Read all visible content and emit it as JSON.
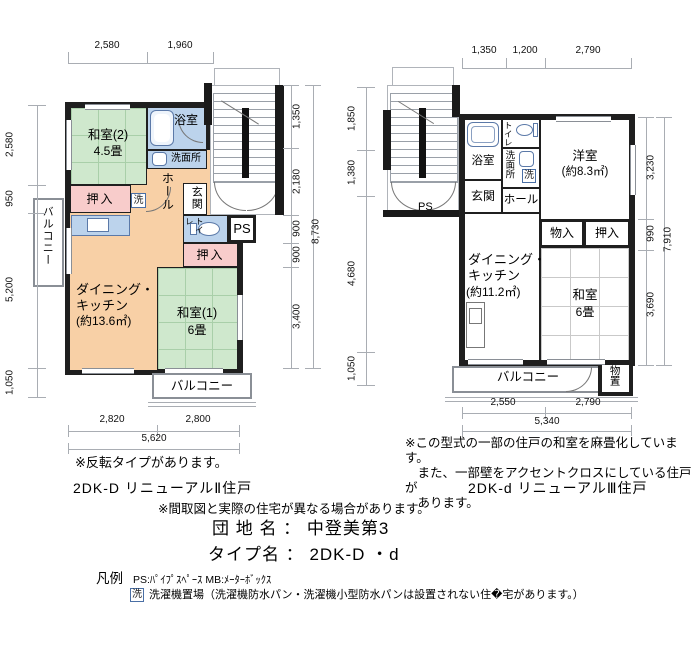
{
  "left": {
    "dims_top": [
      "2,580",
      "1,960"
    ],
    "dims_left": [
      "2,580",
      "950",
      "5,200",
      "1,050"
    ],
    "dims_right": [
      "1,350",
      "2,180",
      "900",
      "900",
      "3,400"
    ],
    "dims_right_total": "8,730",
    "dims_bottom": [
      "2,820",
      "2,800"
    ],
    "dims_bottom_total": "5,620",
    "rooms": {
      "washitsu2": "和室(2)",
      "washitsu2_size": "4.5畳",
      "bath": "浴室",
      "senmenjo": "洗面所",
      "hall": "ホール",
      "genkan": "玄関",
      "toilet": "トイレ",
      "ps": "PS",
      "oshiire1": "押入",
      "oshiire2": "押入",
      "laundry": "洗",
      "dk": "ダイニング・\nキッチン",
      "dk_size": "(約13.6㎡)",
      "washitsu1": "和室(1)",
      "washitsu1_size": "6畳",
      "balcony_left": "バルコニー",
      "balcony_bottom": "バルコニー"
    },
    "note": "※反転タイプがあります。",
    "label": "2DK-D リニューアルⅡ住戸"
  },
  "right": {
    "dims_top": [
      "1,350",
      "1,200",
      "2,790"
    ],
    "dims_left": [
      "1,850",
      "1,380",
      "4,680",
      "1,050"
    ],
    "dims_right": [
      "3,230",
      "990",
      "3,690"
    ],
    "dims_right_total": "7,910",
    "dims_bottom": [
      "2,550",
      "2,790"
    ],
    "dims_bottom_total": "5,340",
    "rooms": {
      "bath": "浴室",
      "toilet": "トイレ",
      "senmenjo": "洗面所",
      "laundry": "洗",
      "genkan": "玄関",
      "hall": "ホール",
      "yoshitsu": "洋室",
      "yoshitsu_size": "(約8.3㎡)",
      "monoiri": "物入",
      "oshiire": "押入",
      "dk": "ダイニング・\nキッチン",
      "dk_size": "(約11.2㎡)",
      "washitsu": "和室",
      "washitsu_size": "6畳",
      "balcony": "バルコニー",
      "storage": "物置",
      "ps": "PS"
    },
    "note": "※この型式の一部の住戸の和室を麻畳化しています。\n　また、一部壁をアクセントクロスにしている住戸が\n　あります。",
    "label": "2DK-d リニューアルⅢ住戸"
  },
  "footer": {
    "disclaimer": "※間取図と実際の住宅が異なる場合があります。",
    "danchi": "団 地 名 ： 中登美第3",
    "type": "タイプ名 ： 2DK-D ・d",
    "legend_title": "凡例",
    "legend_ps": "PS:ﾊﾟｲﾌﾟｽﾍﾟｰｽ MB:ﾒｰﾀｰﾎﾞｯｸｽ",
    "legend_laundry_mark": "洗",
    "legend_laundry": "洗濯機置場（洗濯機防水パン・洗濯機小型防水パンは設置されない住�宅があります。）"
  },
  "colors": {
    "tatami_green": "#cfe8cd",
    "dk_orange": "#f8d0a6",
    "closet_pink": "#f8cccb",
    "wet_blue": "#bcd3ec",
    "wall_black": "#1a1a1a"
  }
}
